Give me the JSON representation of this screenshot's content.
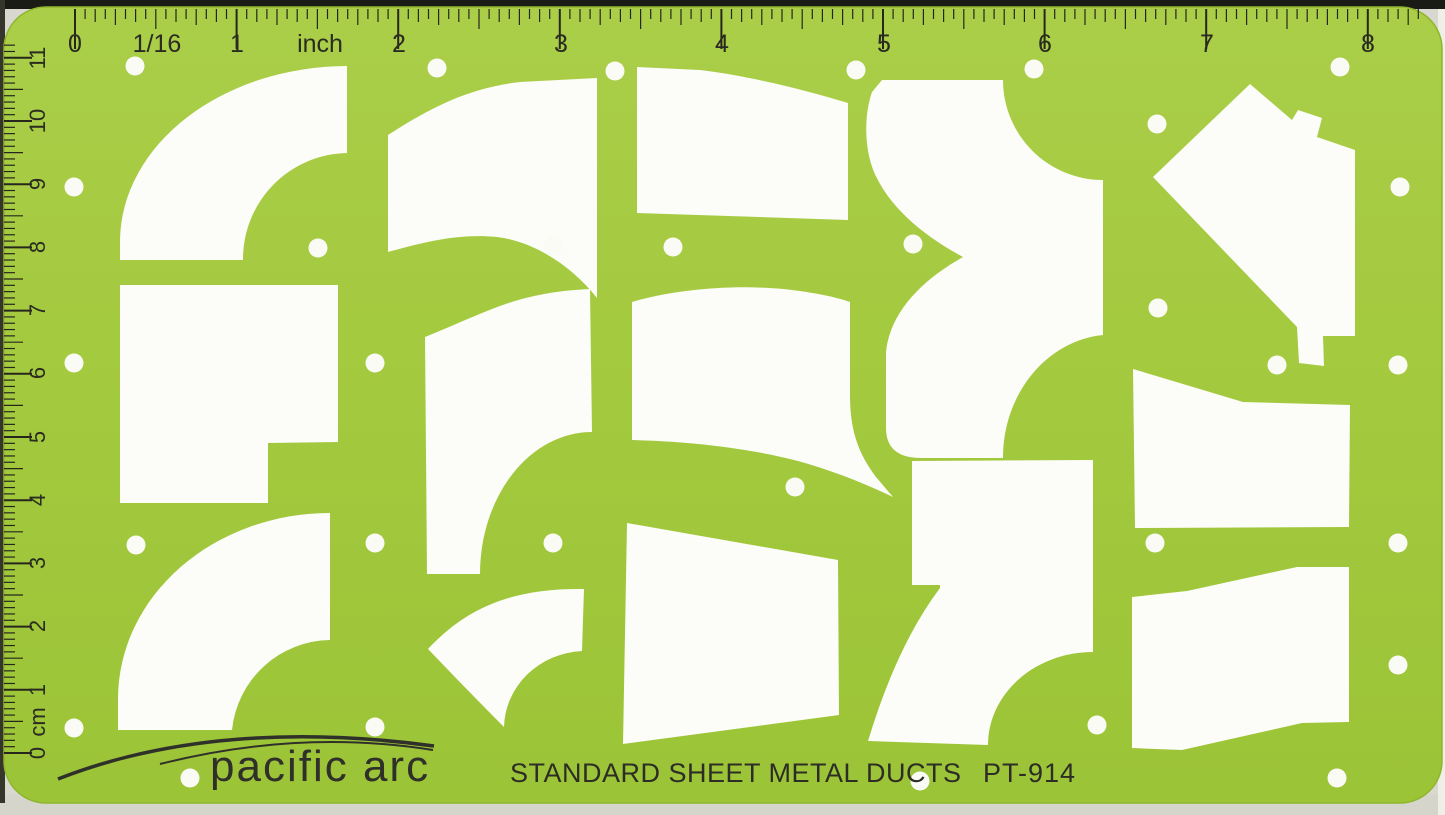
{
  "product": {
    "brand": "pacific arc",
    "title": "STANDARD SHEET METAL DUCTS",
    "model": "PT-914"
  },
  "rulers": {
    "inch": {
      "labels": [
        "0",
        "1/16",
        "1",
        "inch",
        "2",
        "3",
        "4",
        "5",
        "6",
        "7",
        "8"
      ],
      "units_per_side": 8,
      "graduation": "1/16 inch"
    },
    "cm": {
      "labels": [
        "0",
        "cm",
        "1",
        "2",
        "3",
        "4",
        "5",
        "6",
        "7",
        "8",
        "9",
        "10",
        "11"
      ],
      "units_per_side": 11,
      "graduation": "1 mm"
    }
  },
  "cutouts": {
    "count": 14,
    "names": [
      "elbow-90-top-left",
      "s-offset-duct",
      "taper-transition-top",
      "double-elbow-branch",
      "angled-duct-with-collar",
      "square-duct-notched",
      "curved-riser-duct",
      "wave-transition-duct",
      "boot-transition-duct",
      "elbow-90-bottom-left",
      "taper-transition-large",
      "curved-wedge-elbow",
      "offset-transition-right-upper",
      "zigzag-offset-right-lower"
    ]
  },
  "registration_holes": {
    "count": 24
  },
  "colors": {
    "template_green": "#a3c93e",
    "template_green_light": "#aace48",
    "cutout_white": "#fcfcf8",
    "ink": "#2d2d26",
    "photo_edge_dark": "#1b1b15",
    "photo_edge_light": "#d5d5cc"
  }
}
